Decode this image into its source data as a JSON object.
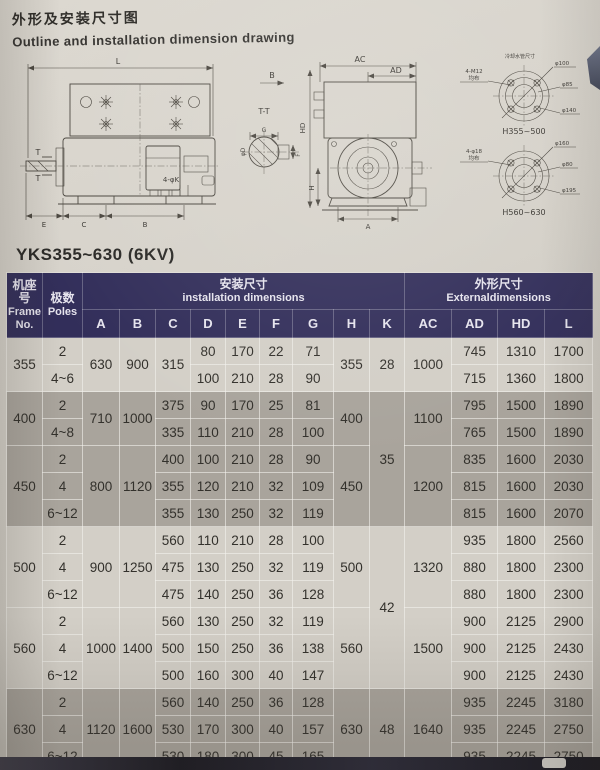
{
  "page": {
    "title_zh": "外形及安装尺寸图",
    "title_en": "Outline and installation dimension drawing",
    "model_heading": "YKS355~630 (6KV)"
  },
  "drawing": {
    "side": {
      "L": "L",
      "E": "E",
      "C": "C",
      "B": "B",
      "foot_holes": "4-φK",
      "T": "T",
      "section": "T-T",
      "G": "G",
      "F": "F",
      "D": "φD",
      "view": "B"
    },
    "end": {
      "AC": "AC",
      "AD": "AD",
      "HD": "HD",
      "H": "H",
      "A": "A"
    },
    "flange_note": "冷却水管尺寸",
    "flange1": {
      "bolts": "4-M12",
      "pattern": "均布",
      "dia_top": "φ100",
      "dia_mid": "φ85",
      "dia_bot": "φ140",
      "name": "H355~500"
    },
    "flange2": {
      "bolts": "4-φ18",
      "pattern": "均布",
      "dia_top": "φ160",
      "dia_mid": "φ80",
      "dia_bot": "φ195",
      "name": "H560~630"
    }
  },
  "table": {
    "header": {
      "frame_zh": "机座号",
      "frame_en": "Frame No.",
      "poles_zh": "极数",
      "poles_en": "Poles",
      "install_zh": "安装尺寸",
      "install_en": "installation dimensions",
      "external_zh": "外形尺寸",
      "external_en": "Externaldimensions"
    },
    "letters": [
      "A",
      "B",
      "C",
      "D",
      "E",
      "F",
      "G",
      "H",
      "K",
      "AC",
      "AD",
      "HD",
      "L"
    ],
    "groups": [
      {
        "frame": "355",
        "A": "630",
        "B": "900",
        "H": "355",
        "K": "28",
        "AC": "1000",
        "rows": [
          {
            "poles": "2",
            "C": "315",
            "D": "80",
            "E": "170",
            "F": "22",
            "G": "71",
            "AD": "745",
            "HD": "1310",
            "L": "1700"
          },
          {
            "poles": "4~6",
            "D": "100",
            "E": "210",
            "F": "28",
            "G": "90",
            "AD": "715",
            "HD": "1360",
            "L": "1800"
          }
        ]
      },
      {
        "frame": "400",
        "A": "710",
        "B": "1000",
        "H": "400",
        "K": "35",
        "AC": "1100",
        "rows": [
          {
            "poles": "2",
            "C": "375",
            "D": "90",
            "E": "170",
            "F": "25",
            "G": "81",
            "AD": "795",
            "HD": "1500",
            "L": "1890"
          },
          {
            "poles": "4~8",
            "C": "335",
            "D": "110",
            "E": "210",
            "F": "28",
            "G": "100",
            "AD": "765",
            "HD": "1500",
            "L": "1890"
          }
        ]
      },
      {
        "frame": "450",
        "A": "800",
        "B": "1120",
        "H": "450",
        "AC": "1200",
        "rows": [
          {
            "poles": "2",
            "C": "400",
            "D": "100",
            "E": "210",
            "F": "28",
            "G": "90",
            "AD": "835",
            "HD": "1600",
            "L": "2030"
          },
          {
            "poles": "4",
            "C": "355",
            "D": "120",
            "E": "210",
            "F": "32",
            "G": "109",
            "AD": "815",
            "HD": "1600",
            "L": "2030"
          },
          {
            "poles": "6~12",
            "C": "355",
            "D": "130",
            "E": "250",
            "F": "32",
            "G": "119",
            "AD": "815",
            "HD": "1600",
            "L": "2070"
          }
        ]
      },
      {
        "frame": "500",
        "A": "900",
        "B": "1250",
        "H": "500",
        "K": "42",
        "AC": "1320",
        "rows": [
          {
            "poles": "2",
            "C": "560",
            "D": "110",
            "E": "210",
            "F": "28",
            "G": "100",
            "AD": "935",
            "HD": "1800",
            "L": "2560"
          },
          {
            "poles": "4",
            "C": "475",
            "D": "130",
            "E": "250",
            "F": "32",
            "G": "119",
            "AD": "880",
            "HD": "1800",
            "L": "2300"
          },
          {
            "poles": "6~12",
            "C": "475",
            "D": "140",
            "E": "250",
            "F": "36",
            "G": "128",
            "AD": "880",
            "HD": "1800",
            "L": "2300"
          }
        ]
      },
      {
        "frame": "560",
        "A": "1000",
        "B": "1400",
        "H": "560",
        "AC": "1500",
        "rows": [
          {
            "poles": "2",
            "C": "560",
            "D": "130",
            "E": "250",
            "F": "32",
            "G": "119",
            "AD": "900",
            "HD": "2125",
            "L": "2900"
          },
          {
            "poles": "4",
            "C": "500",
            "D": "150",
            "E": "250",
            "F": "36",
            "G": "138",
            "AD": "900",
            "HD": "2125",
            "L": "2430"
          },
          {
            "poles": "6~12",
            "C": "500",
            "D": "160",
            "E": "300",
            "F": "40",
            "G": "147",
            "AD": "900",
            "HD": "2125",
            "L": "2430"
          }
        ]
      },
      {
        "frame": "630",
        "A": "1120",
        "B": "1600",
        "H": "630",
        "K": "48",
        "AC": "1640",
        "rows": [
          {
            "poles": "2",
            "C": "560",
            "D": "140",
            "E": "250",
            "F": "36",
            "G": "128",
            "AD": "935",
            "HD": "2245",
            "L": "3180"
          },
          {
            "poles": "4",
            "C": "530",
            "D": "170",
            "E": "300",
            "F": "40",
            "G": "157",
            "AD": "935",
            "HD": "2245",
            "L": "2750"
          },
          {
            "poles": "6~12",
            "C": "530",
            "D": "180",
            "E": "300",
            "F": "45",
            "G": "165",
            "AD": "935",
            "HD": "2245",
            "L": "2750"
          }
        ]
      }
    ]
  }
}
